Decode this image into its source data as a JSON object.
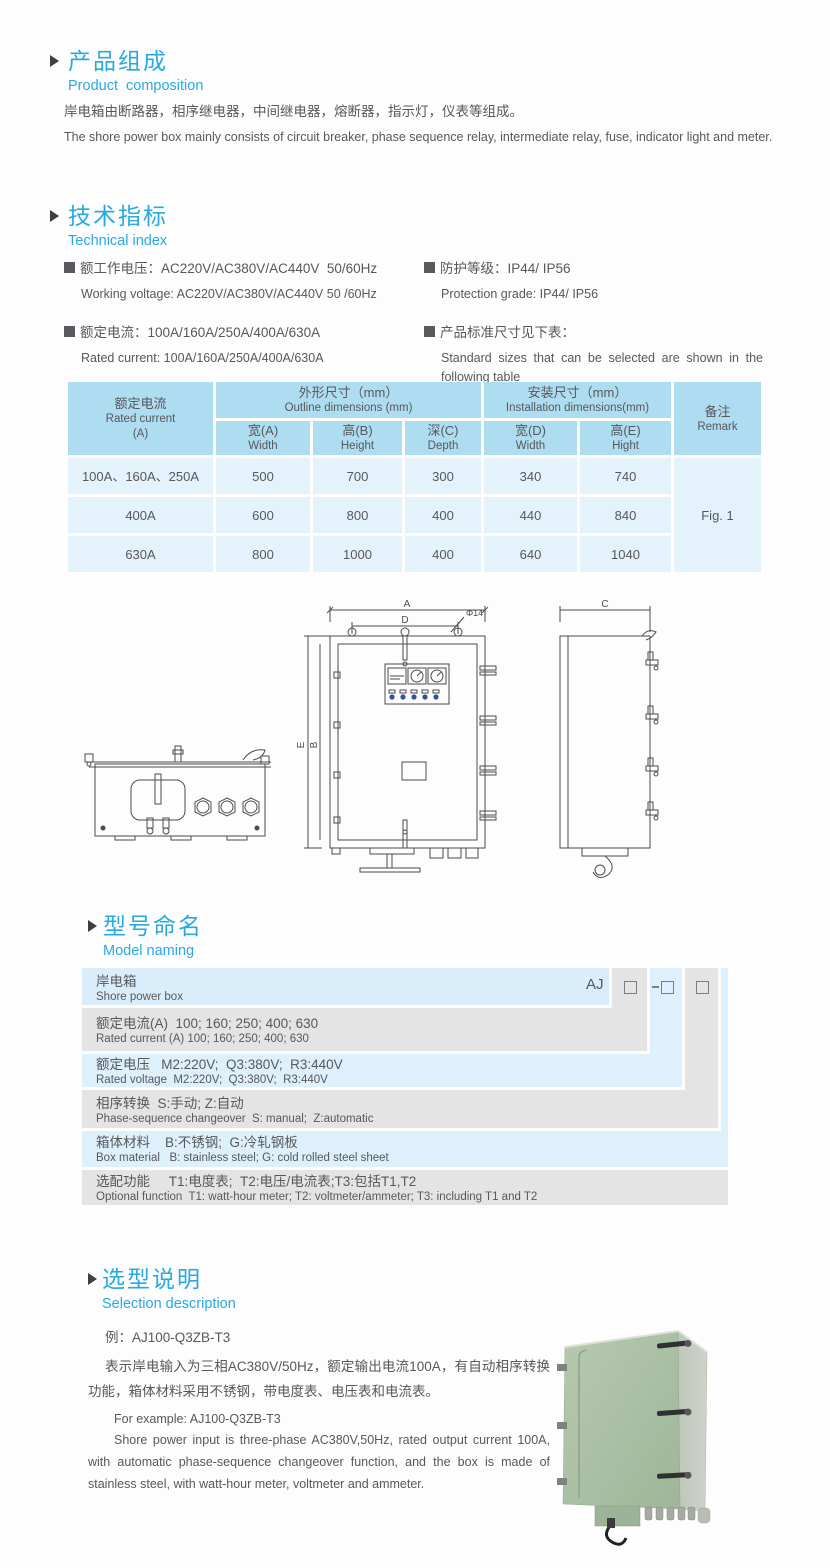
{
  "icons": {
    "section_marker": "triangle-right",
    "bullet": "filled-square",
    "model_placeholder": "empty-square-box"
  },
  "colors": {
    "accent_blue": "#29a9e1",
    "table_header_blue": "#aedcf0",
    "table_row_blue": "#e3f2fb",
    "naming_gray": "#e4e4e4",
    "naming_blue": "#ddf0fb",
    "text_gray": "#57585b",
    "photo_green": "#a9bfa3"
  },
  "composition": {
    "title_zh": "产品组成",
    "title_en": "Product  composition",
    "para_zh": "岸电箱由断路器，相序继电器，中间继电器，熔断器，指示灯，仪表等组成。",
    "para_en": "The shore power box mainly consists of circuit breaker, phase sequence relay, intermediate relay, fuse, indicator light and meter."
  },
  "technical": {
    "title_zh": "技术指标",
    "title_en": "Technical index",
    "left": [
      {
        "zh": "额工作电压：AC220V/AC380V/AC440V  50/60Hz",
        "en": "Working voltage: AC220V/AC380V/AC440V 50 /60Hz"
      },
      {
        "zh": "额定电流：100A/160A/250A/400A/630A",
        "en": "Rated current: 100A/160A/250A/400A/630A"
      }
    ],
    "right": [
      {
        "zh": "防护等级：IP44/ IP56",
        "en": "Protection grade: IP44/ IP56"
      },
      {
        "zh": "产品标准尺寸见下表：",
        "en": "Standard sizes that can be selected are shown in the following table"
      }
    ]
  },
  "size_table": {
    "header": {
      "col1_zh": "额定电流",
      "col1_en": "Rated current",
      "col1_unit": "(A)",
      "group1_zh": "外形尺寸（mm）",
      "group1_en": "Outline dimensions (mm)",
      "group2_zh": "安装尺寸（mm）",
      "group2_en": "Installation dimensions(mm)",
      "remark_zh": "备注",
      "remark_en": "Remark",
      "sub": [
        {
          "zh": "宽(A)",
          "en": "Width"
        },
        {
          "zh": "高(B)",
          "en": "Height"
        },
        {
          "zh": "深(C)",
          "en": "Depth"
        },
        {
          "zh": "宽(D)",
          "en": "Width"
        },
        {
          "zh": "高(E)",
          "en": "Hight"
        }
      ]
    },
    "rows": [
      {
        "current": "100A、160A、250A",
        "w": "500",
        "h": "700",
        "d": "300",
        "iw": "340",
        "ih": "740"
      },
      {
        "current": "400A",
        "w": "600",
        "h": "800",
        "d": "400",
        "iw": "440",
        "ih": "840"
      },
      {
        "current": "630A",
        "w": "800",
        "h": "1000",
        "d": "400",
        "iw": "640",
        "ih": "1040"
      }
    ],
    "remark_value": "Fig. 1"
  },
  "drawing": {
    "labels": {
      "a": "A",
      "b": "B",
      "c": "C",
      "d": "D",
      "e": "E",
      "dia": "Φ14"
    }
  },
  "model_naming": {
    "title_zh": "型号命名",
    "title_en": "Model naming",
    "prefix": "AJ",
    "rows": [
      {
        "zh": "岸电箱",
        "en": "Shore power box"
      },
      {
        "zh": "额定电流(A)  100; 160; 250; 400; 630",
        "en": "Rated current (A) 100; 160; 250; 400; 630"
      },
      {
        "zh": "额定电压   M2:220V;  Q3:380V;  R3:440V",
        "en": "Rated voltage  M2:220V;  Q3:380V;  R3:440V"
      },
      {
        "zh": "相序转换  S:手动; Z:自动",
        "en": "Phase-sequence changeover  S: manual;  Z:automatic"
      },
      {
        "zh": "箱体材料    B:不锈钢;  G:冷轧钢板",
        "en": "Box material   B: stainless steel; G: cold rolled steel sheet"
      },
      {
        "zh": "选配功能     T1:电度表;  T2:电压/电流表;T3:包括T1,T2",
        "en": "Optional function  T1: watt-hour meter; T2: voltmeter/ammeter; T3: including T1 and T2"
      }
    ]
  },
  "selection": {
    "title_zh": "选型说明",
    "title_en": "Selection description",
    "example_zh": "例：AJ100-Q3ZB-T3",
    "para_zh": "表示岸电输入为三相AC380V/50Hz，额定输出电流100A，有自动相序转换功能，箱体材料采用不锈钢，带电度表、电压表和电流表。",
    "example_en": "For example: AJ100-Q3ZB-T3",
    "para_en": "Shore power input is three-phase AC380V,50Hz, rated output current 100A, with automatic phase-sequence changeover function, and the box is made of stainless steel, with watt-hour meter, voltmeter and ammeter."
  }
}
